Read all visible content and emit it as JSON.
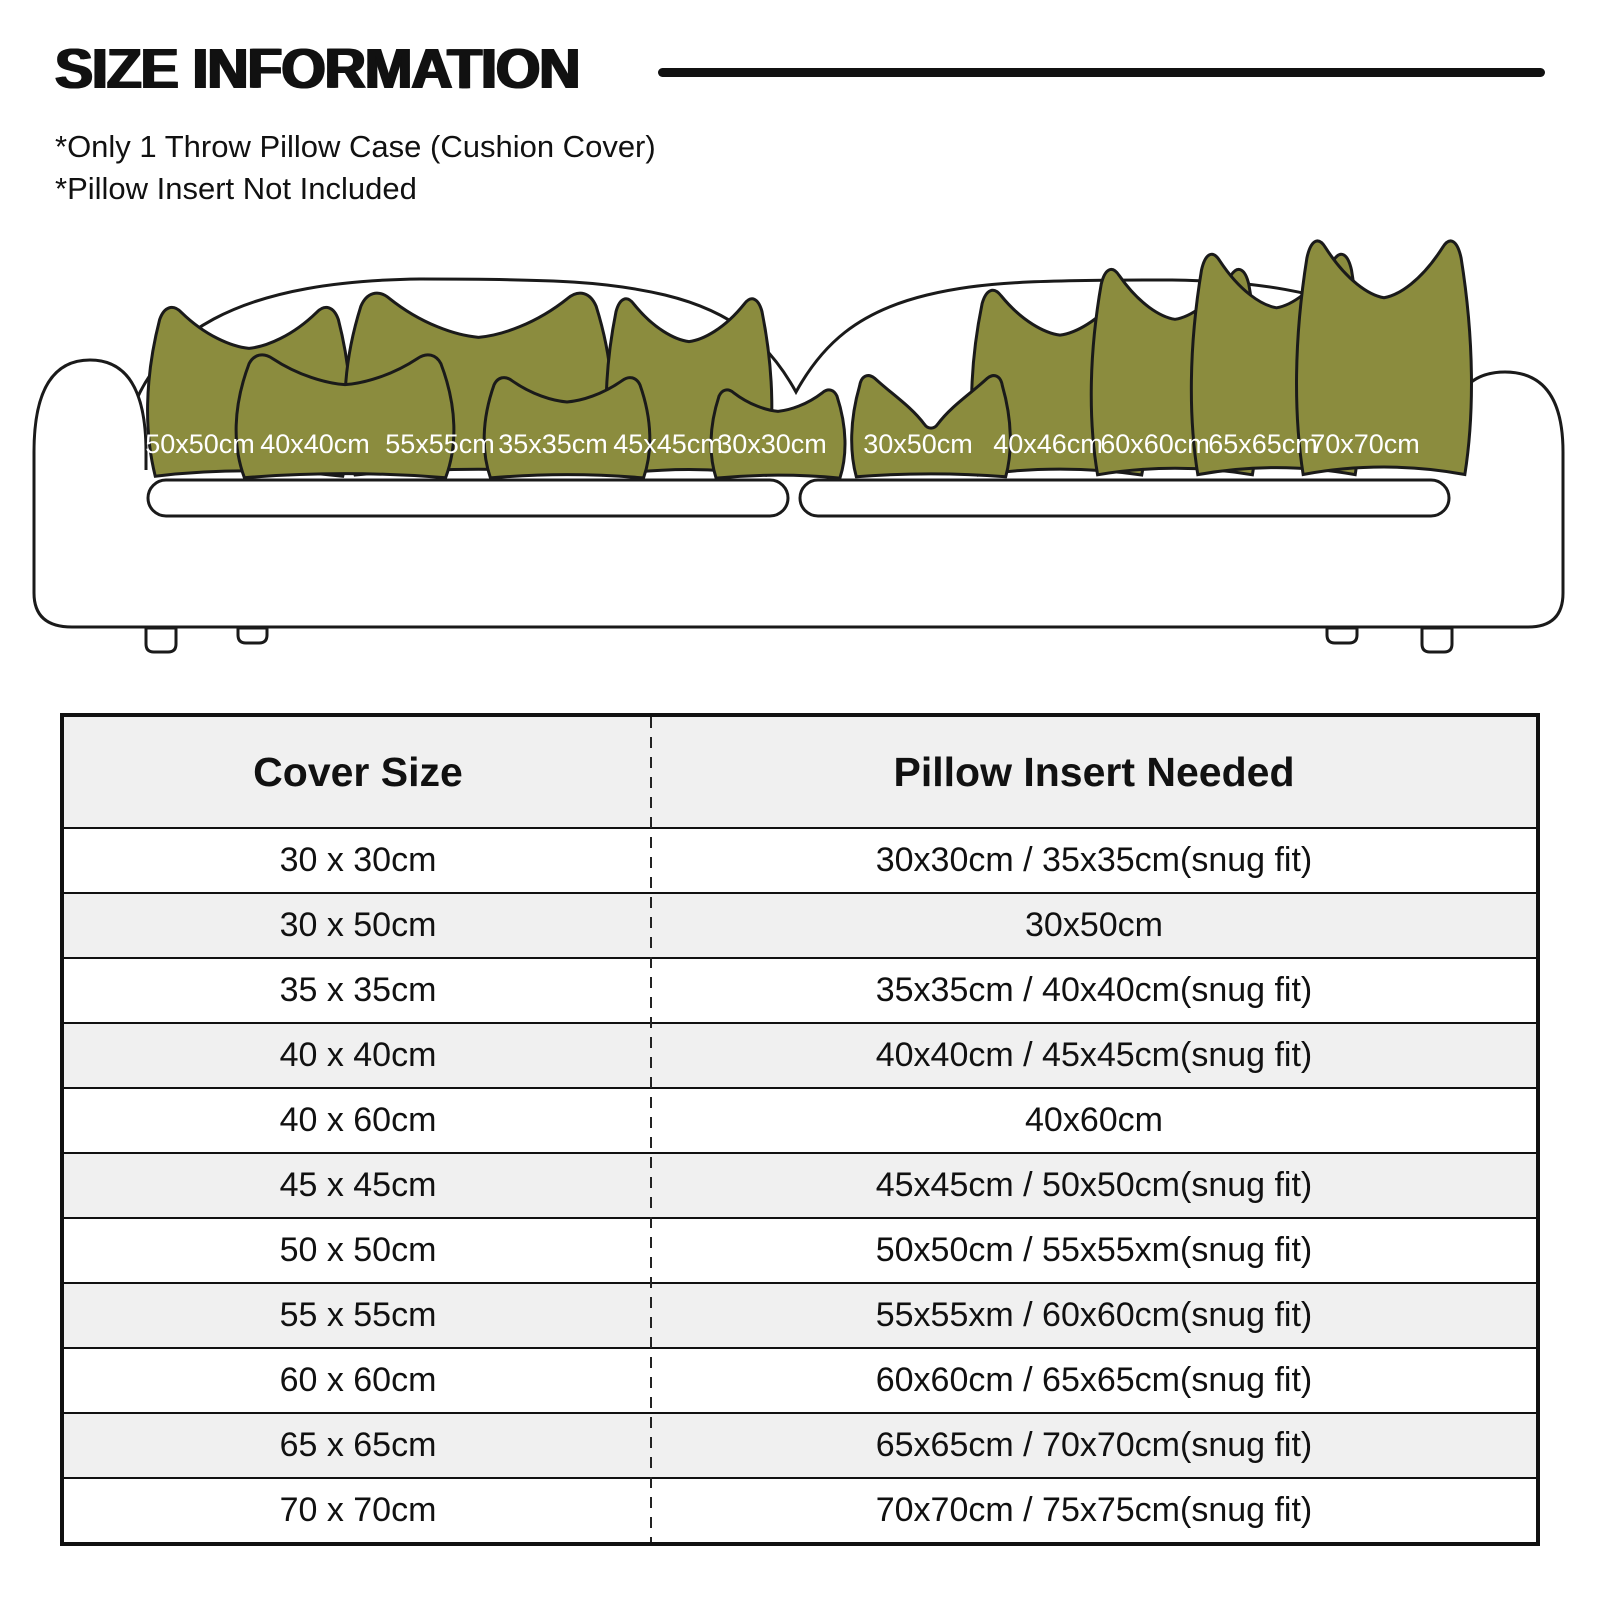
{
  "header": {
    "title": "SIZE INFORMATION",
    "notes": [
      "*Only 1 Throw Pillow Case (Cushion Cover)",
      "*Pillow Insert Not Included"
    ]
  },
  "sofa": {
    "pillow_color": "#8b8c3e",
    "outline_color": "#1a1a1a",
    "pillows": [
      {
        "label": "50x50cm"
      },
      {
        "label": "40x40cm"
      },
      {
        "label": "55x55cm"
      },
      {
        "label": "35x35cm"
      },
      {
        "label": "45x45cm"
      },
      {
        "label": "30x30cm"
      },
      {
        "label": "30x50cm"
      },
      {
        "label": "40x46cm"
      },
      {
        "label": "60x60cm"
      },
      {
        "label": "65x65cm"
      },
      {
        "label": "70x70cm"
      }
    ]
  },
  "table": {
    "headers": {
      "cover": "Cover Size",
      "insert": "Pillow Insert Needed"
    },
    "alt_row_color": "#f0f0f0",
    "rows": [
      {
        "cover": "30 x 30cm",
        "insert": "30x30cm / 35x35cm(snug fit)"
      },
      {
        "cover": "30 x 50cm",
        "insert": "30x50cm"
      },
      {
        "cover": "35 x 35cm",
        "insert": "35x35cm / 40x40cm(snug fit)"
      },
      {
        "cover": "40 x 40cm",
        "insert": "40x40cm / 45x45cm(snug fit)"
      },
      {
        "cover": "40 x 60cm",
        "insert": "40x60cm"
      },
      {
        "cover": "45 x 45cm",
        "insert": "45x45cm / 50x50cm(snug fit)"
      },
      {
        "cover": "50 x 50cm",
        "insert": "50x50cm / 55x55xm(snug fit)"
      },
      {
        "cover": "55 x 55cm",
        "insert": "55x55xm / 60x60cm(snug fit)"
      },
      {
        "cover": "60 x 60cm",
        "insert": "60x60cm / 65x65cm(snug fit)"
      },
      {
        "cover": "65 x 65cm",
        "insert": "65x65cm / 70x70cm(snug fit)"
      },
      {
        "cover": "70 x 70cm",
        "insert": "70x70cm / 75x75cm(snug fit)"
      }
    ]
  }
}
